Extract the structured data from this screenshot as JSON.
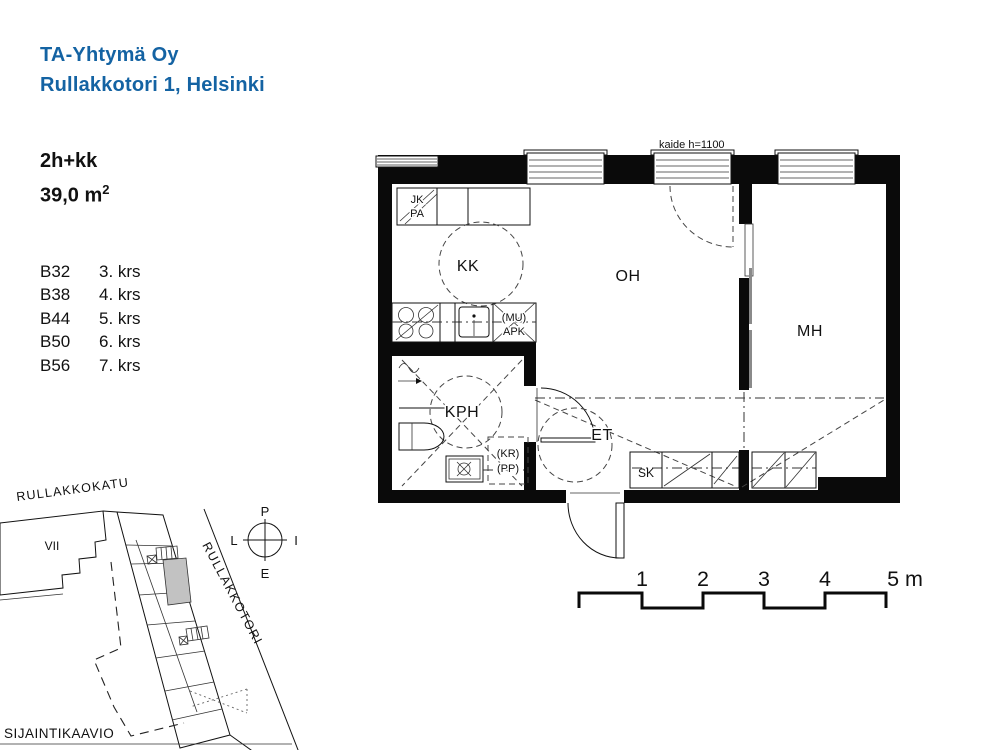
{
  "colors": {
    "brand_blue": "#1463A3",
    "unit_highlight": "#C2C2C2",
    "ink": "#111111"
  },
  "header": {
    "company": "TA-Yhtymä Oy",
    "address": "Rullakkotori 1, Helsinki"
  },
  "apartment": {
    "type": "2h+kk",
    "area_base": "39,0 m",
    "area_exponent": "2",
    "units": [
      {
        "code": "B32",
        "floor": "3. krs"
      },
      {
        "code": "B38",
        "floor": "4. krs"
      },
      {
        "code": "B44",
        "floor": "5. krs"
      },
      {
        "code": "B50",
        "floor": "6. krs"
      },
      {
        "code": "B56",
        "floor": "7. krs"
      }
    ]
  },
  "floorplan": {
    "note_railing": "kaide h=1100",
    "rooms": {
      "kitchenette": "KK",
      "living_room": "OH",
      "bedroom": "MH",
      "bathroom": "KPH",
      "entry": "ET",
      "closet": "SK"
    },
    "fixtures": {
      "fridge": "JK",
      "freezer": "PA",
      "dishwasher_res_line1": "(MU)",
      "dishwasher_res_line2": "APK",
      "drying_res_line1": "(KR)",
      "drying_res_line2": "(PP)"
    }
  },
  "site_map": {
    "caption": "SIJAINTIKAAVIO",
    "street_top": "RULLAKKOKATU",
    "street_right": "RULLAKKOTORI",
    "block_number": "VII",
    "compass": {
      "north": "P",
      "east": "I",
      "south": "E",
      "west": "L"
    }
  },
  "scale_bar": {
    "tick_1": "1",
    "tick_2": "2",
    "tick_3": "3",
    "tick_4": "4",
    "tick_5": "5 m"
  }
}
